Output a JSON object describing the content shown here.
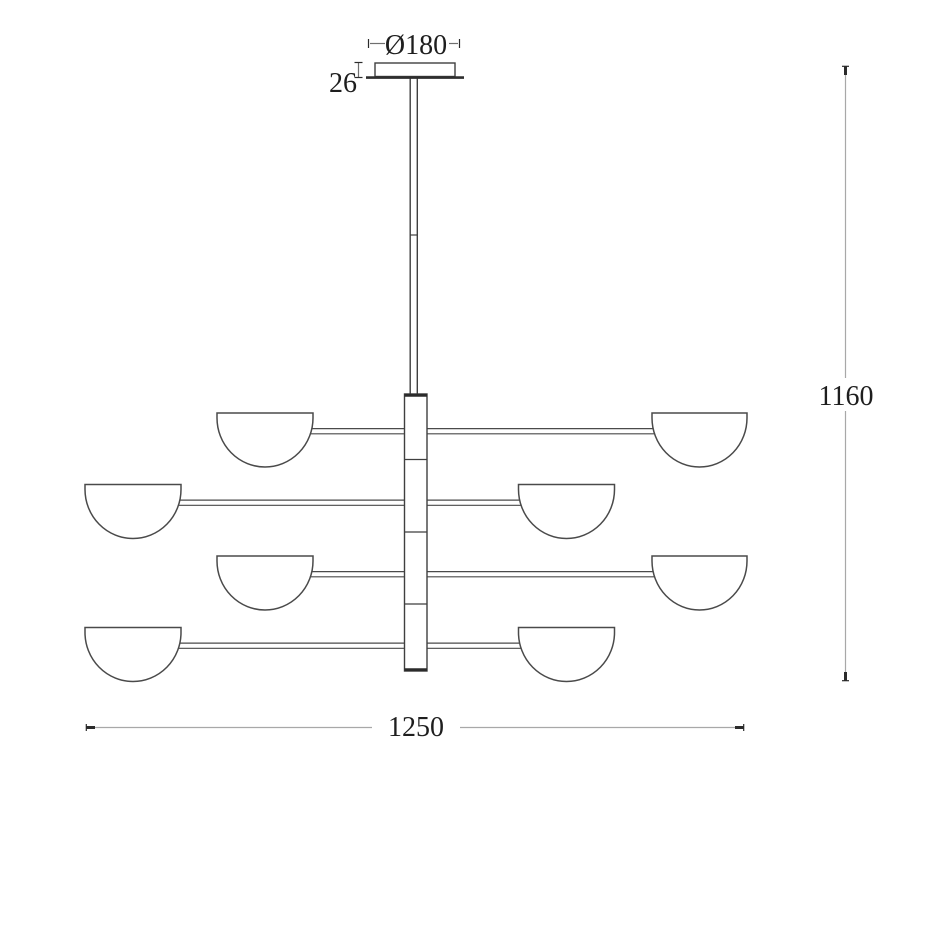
{
  "drawing": {
    "kind": "technical dimension drawing",
    "subject": "eight-shade tiered chandelier pendant lamp, front elevation",
    "labels": {
      "canopy_diameter": "Ø180",
      "canopy_height": "26",
      "overall_height": "1160",
      "overall_width": "1250"
    },
    "structure": {
      "shade_rows": 4,
      "shades_per_row": 2,
      "shades_total": 8,
      "stem_segments": 4
    },
    "colors": {
      "background": "#ffffff",
      "fixture_outline": "#3f3f3f",
      "shade_outline": "#4a4a4a",
      "dimension_line": "#a8a8a8",
      "tick": "#2b2b2b",
      "text": "#1e1e1e"
    }
  }
}
